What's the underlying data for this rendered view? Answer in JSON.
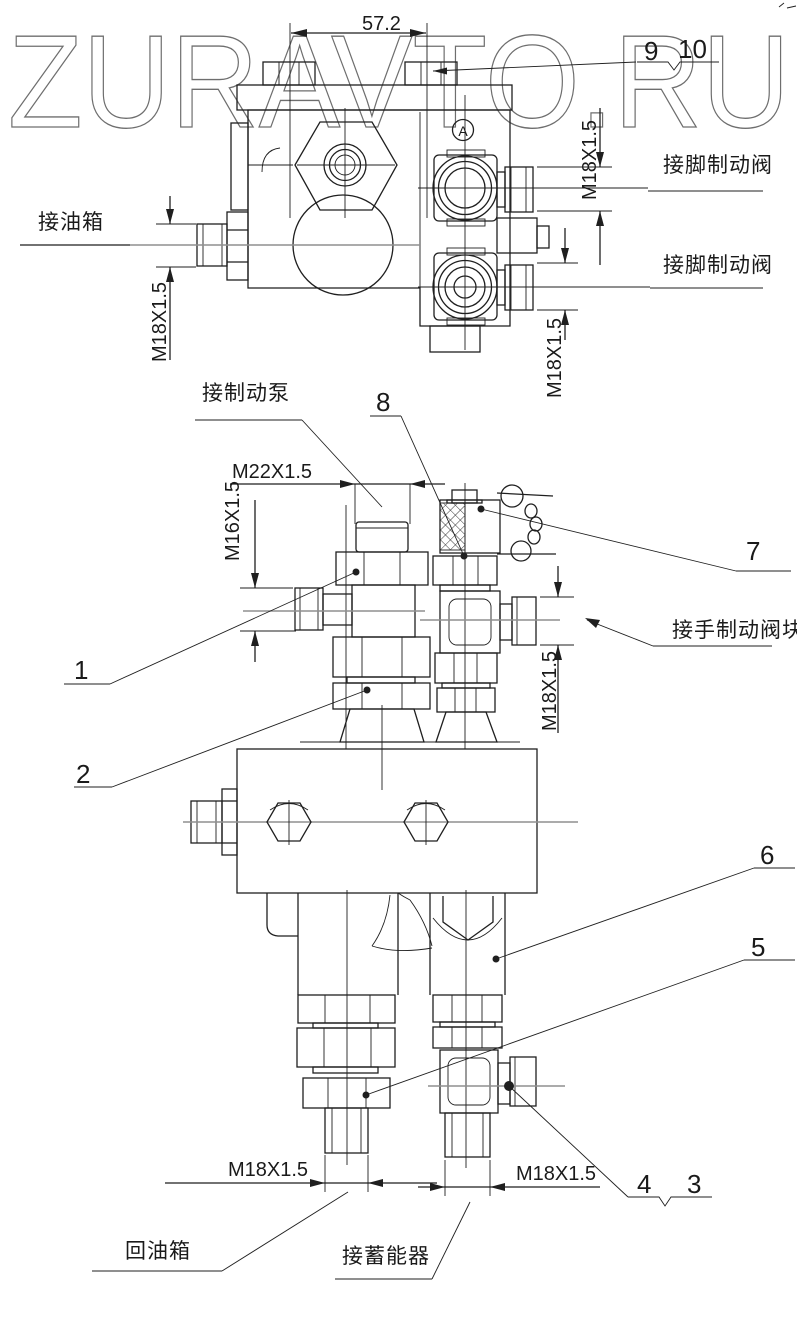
{
  "watermark": "ZURAVTO.RU",
  "datum": {
    "label": "A"
  },
  "callouts": {
    "n1": "1",
    "n2": "2",
    "n3": "3",
    "n4": "4",
    "n5": "5",
    "n6": "6",
    "n7": "7",
    "n8": "8",
    "n9": "9",
    "n10": "10"
  },
  "dimensions": {
    "top_width": "57.2",
    "m18": "M18X1.5",
    "m22": "M22X1.5",
    "m16": "M16X1.5"
  },
  "labels": {
    "oil_tank": "接油箱",
    "foot_brake_valve_upper": "接脚制动阀",
    "foot_brake_valve_lower": "接脚制动阀",
    "brake_pump": "接制动泵",
    "hand_brake_valve_block": "接手制动阀块",
    "return_oil_tank": "回油箱",
    "accumulator": "接蓄能器"
  }
}
